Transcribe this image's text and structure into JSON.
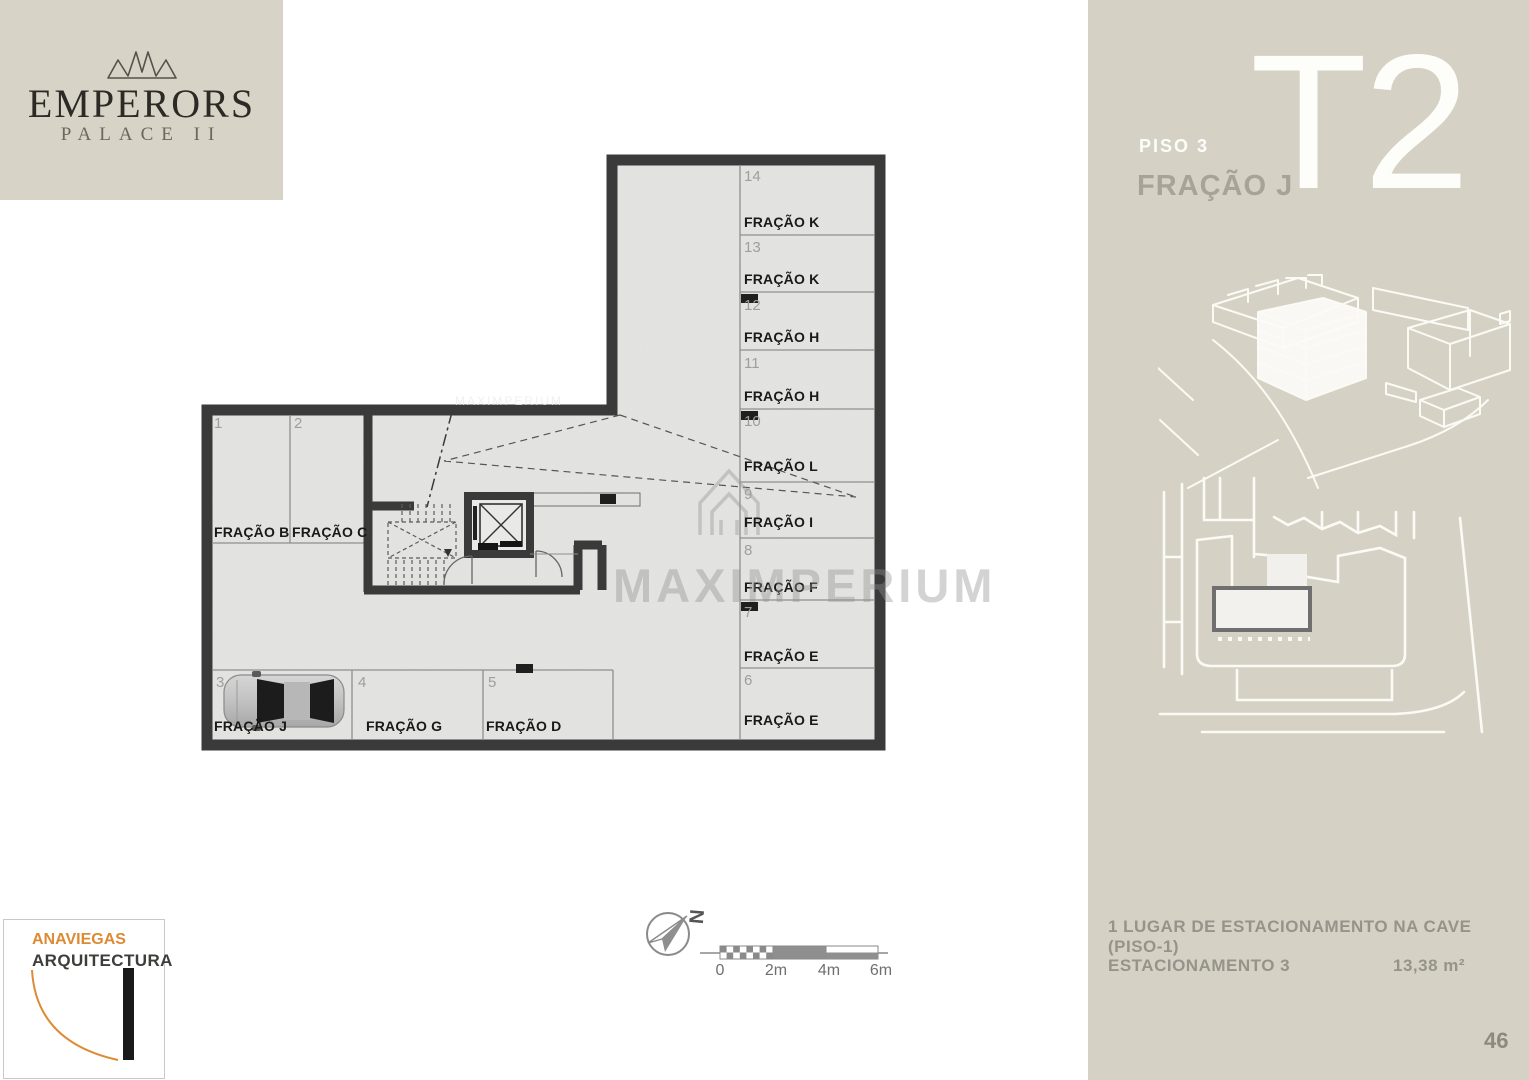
{
  "brand": {
    "name": "EMPERORS",
    "sub": "PALACE II"
  },
  "unit": {
    "floor": "PISO 3",
    "fraction": "FRAÇÃO J",
    "type": "T2"
  },
  "plan": {
    "right": [
      {
        "n": "14",
        "label": "FRAÇÃO K"
      },
      {
        "n": "13",
        "label": "FRAÇÃO K"
      },
      {
        "n": "12",
        "label": "FRAÇÃO H"
      },
      {
        "n": "11",
        "label": "FRAÇÃO H"
      },
      {
        "n": "10",
        "label": "FRAÇÃO L"
      },
      {
        "n": "9",
        "label": "FRAÇÃO I"
      },
      {
        "n": "8",
        "label": "FRAÇÃO F"
      },
      {
        "n": "7",
        "label": "FRAÇÃO E"
      },
      {
        "n": "6",
        "label": "FRAÇÃO E"
      }
    ],
    "left": [
      {
        "n": "1",
        "label": "FRAÇÃO B"
      },
      {
        "n": "2",
        "label": "FRAÇÃO C"
      }
    ],
    "bottom": [
      {
        "n": "3",
        "label": "FRAÇÃO J"
      },
      {
        "n": "4",
        "label": "FRAÇÃO G"
      },
      {
        "n": "5",
        "label": "FRAÇÃO D"
      }
    ]
  },
  "watermark": "MAXIMPERIUM",
  "compass": {
    "north": "N"
  },
  "scalebar": {
    "labels": [
      "0",
      "2m",
      "4m",
      "6m"
    ]
  },
  "info": {
    "line1": "1 LUGAR DE ESTACIONAMENTO NA CAVE (PISO-1)",
    "line2": "ESTACIONAMENTO 3",
    "area": "13,38 m²"
  },
  "page_number": "46",
  "architect": {
    "line1": "ANAVIEGAS",
    "line2": "ARQUITECTURA"
  },
  "colors": {
    "panel_beige": "#d5d2c5",
    "wall_dark": "#3a3a3a",
    "floor_gray": "#e4e4e2",
    "accent_orange": "#dd8a33",
    "info_gray": "#96938a"
  }
}
